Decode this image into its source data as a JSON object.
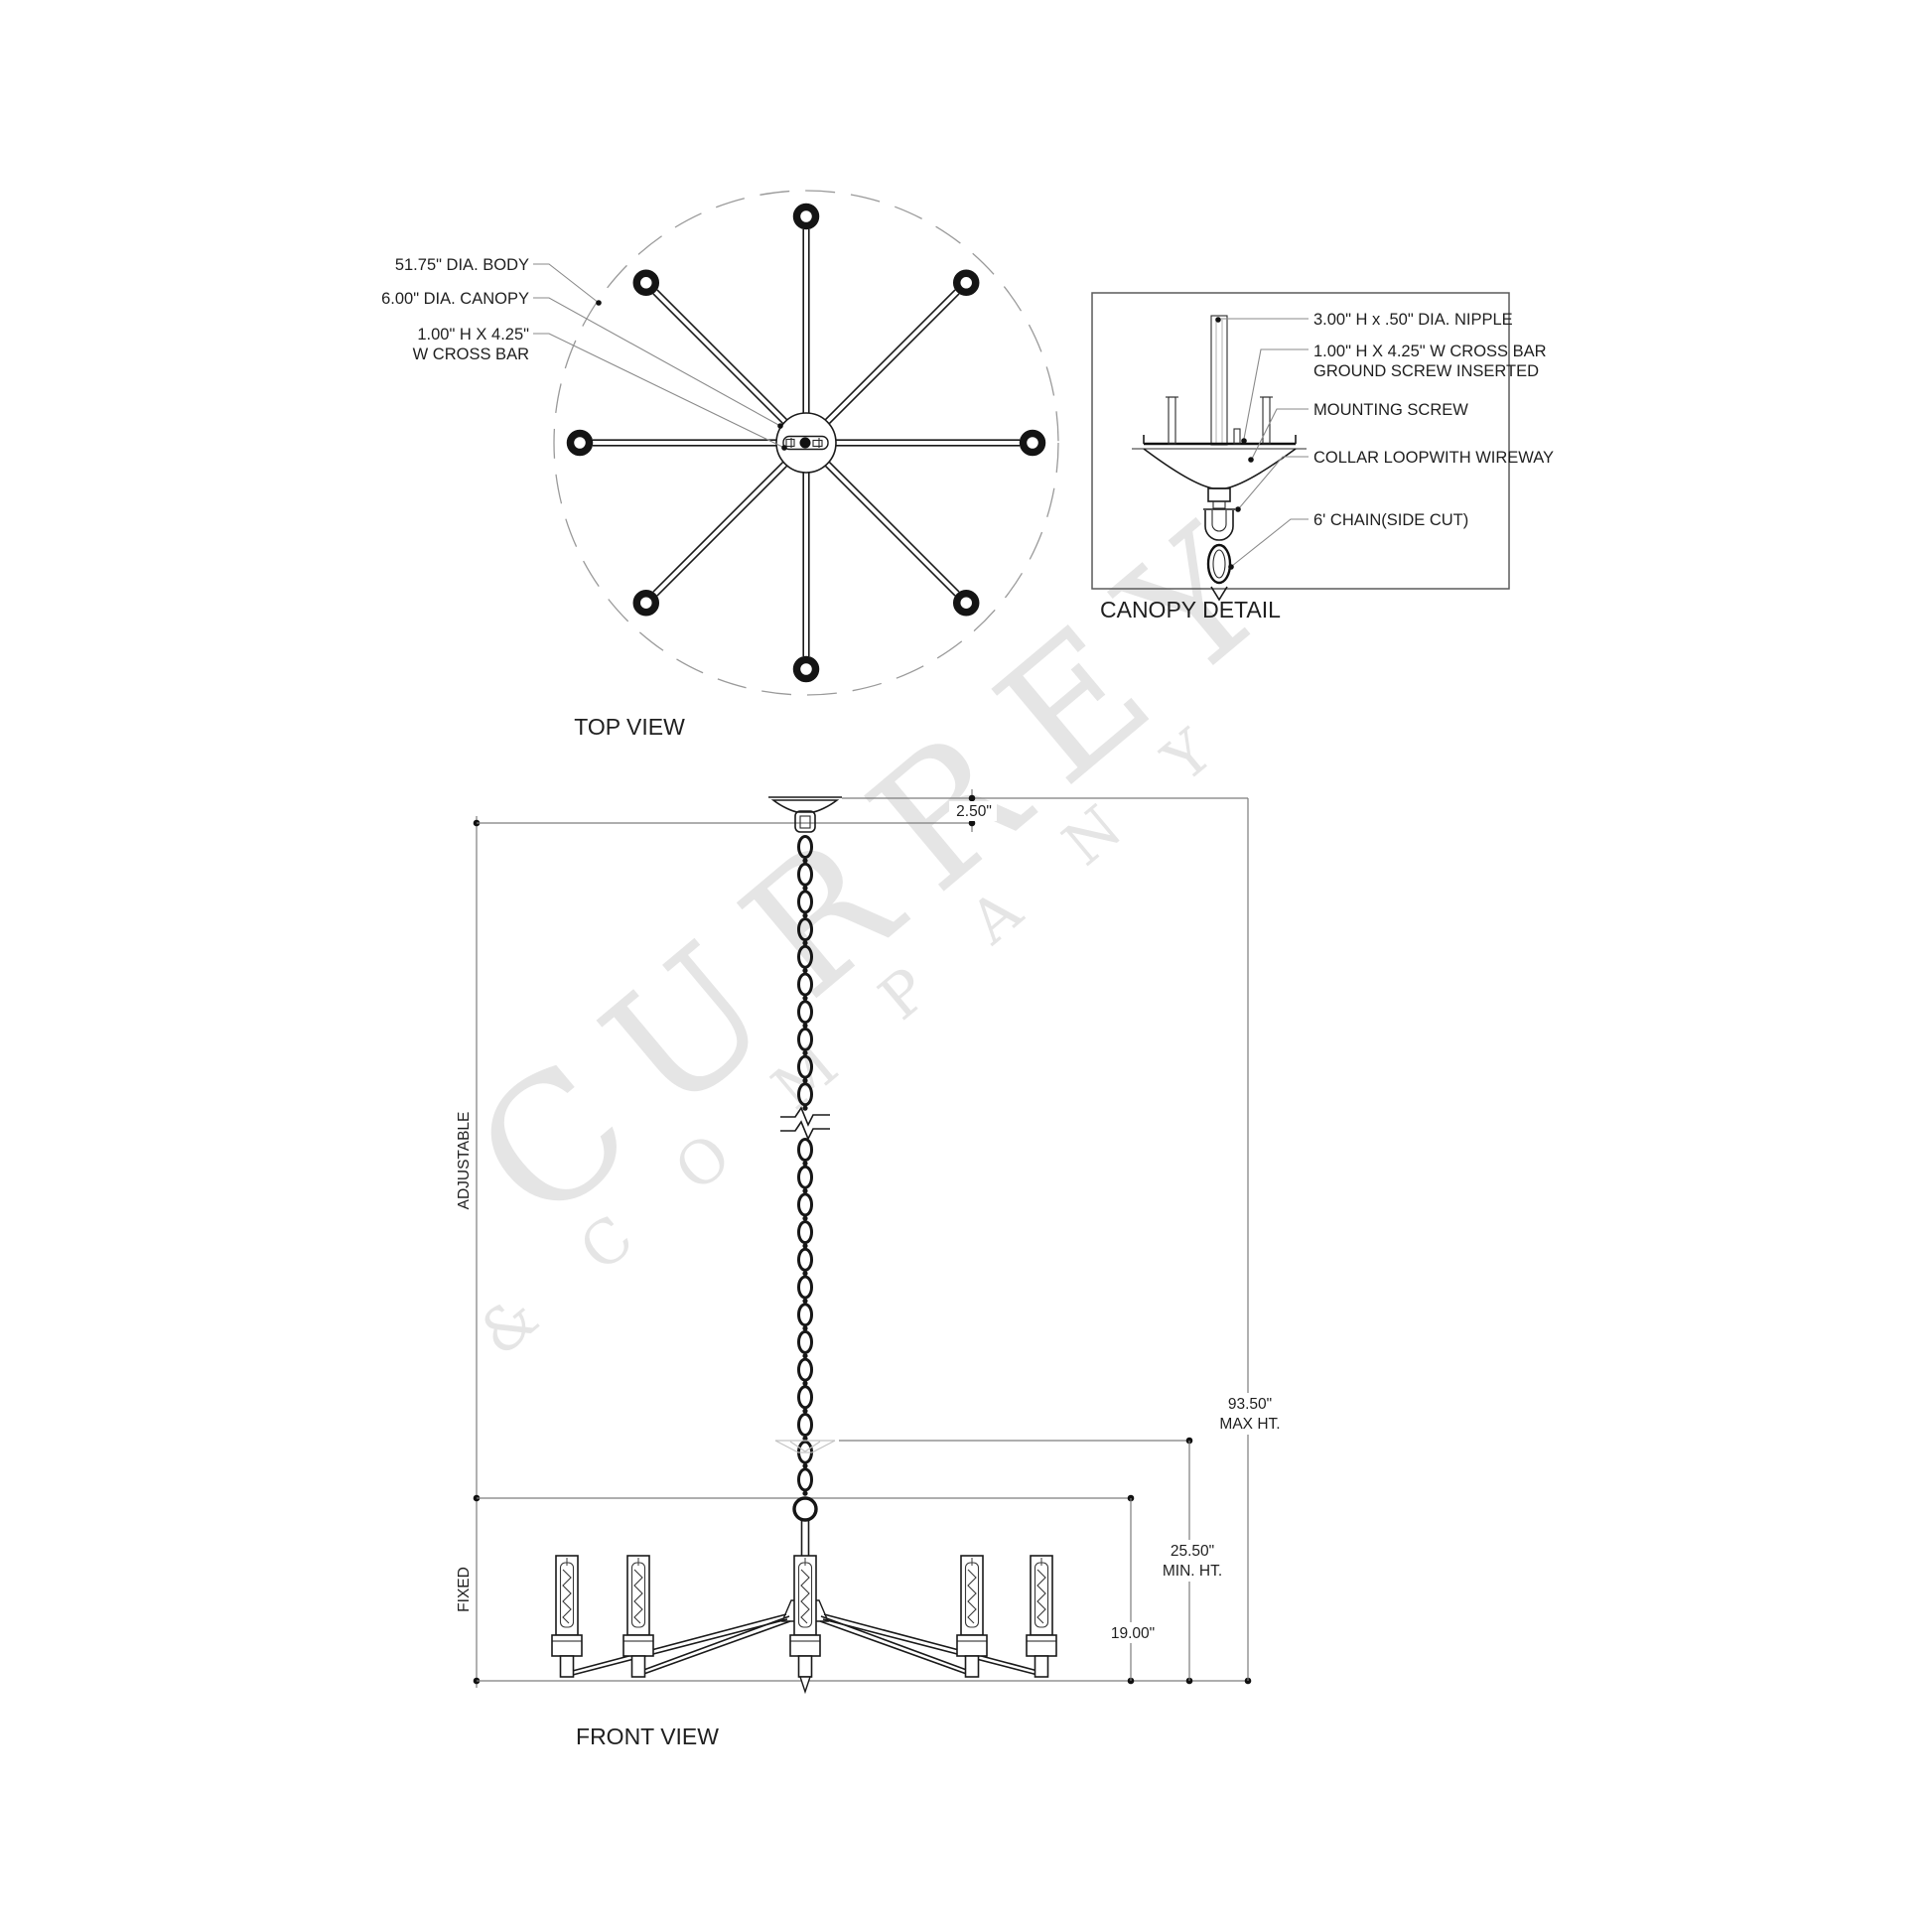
{
  "watermark": {
    "line1": "CURREY",
    "line2": "&  C O M P A N Y"
  },
  "top_view": {
    "title": "TOP VIEW",
    "labels": {
      "body_dia": "51.75\" DIA. BODY",
      "canopy_dia": "6.00\" DIA. CANOPY",
      "crossbar_line1": "1.00\" H X 4.25\"",
      "crossbar_line2": "W CROSS BAR"
    }
  },
  "canopy_detail": {
    "title": "CANOPY DETAIL",
    "labels": {
      "nipple": "3.00\" H x .50\" DIA. NIPPLE",
      "crossbar_line1": "1.00\" H X 4.25\" W CROSS BAR",
      "crossbar_line2": "GROUND SCREW INSERTED",
      "mounting_screw": "MOUNTING SCREW",
      "collar_loop": "COLLAR LOOPWITH WIREWAY",
      "chain": "6' CHAIN(SIDE CUT)"
    }
  },
  "front_view": {
    "title": "FRONT VIEW",
    "dimensions": {
      "canopy_height": "2.50\"",
      "max_height_value": "93.50\"",
      "max_height_label": "MAX HT.",
      "min_height_value": "25.50\"",
      "min_height_label": "MIN. HT.",
      "body_height": "19.00\"",
      "adjustable": "ADJUSTABLE",
      "fixed": "FIXED"
    }
  }
}
